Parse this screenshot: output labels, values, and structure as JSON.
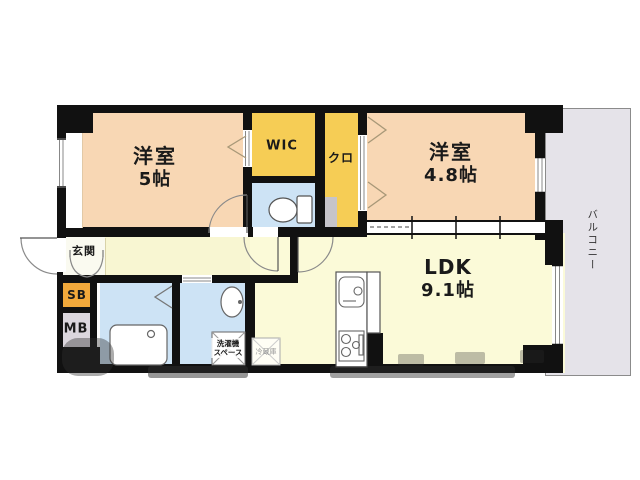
{
  "plan": {
    "rooms": {
      "bedroom1": {
        "name": "洋室",
        "size": "5帖"
      },
      "bedroom2": {
        "name": "洋室",
        "size": "4.8帖"
      },
      "ldk": {
        "name": "LDK",
        "size": "9.1帖"
      },
      "wic": {
        "name": "WIC"
      },
      "closet": {
        "name": "クロ"
      },
      "entrance": {
        "name": "玄関"
      },
      "shoe_box": {
        "name": "SB"
      },
      "meter_box": {
        "name": "MB"
      },
      "balcony": {
        "name": "バルコニー"
      }
    },
    "annotations": {
      "laundry_line1": "洗濯機",
      "laundry_line2": "スペース",
      "refrigerator": "冷蔵庫"
    },
    "icons": {
      "toilet": "toilet-icon",
      "bathtub": "bathtub-icon",
      "washbasin": "washbasin-icon",
      "kitchen_sink": "kitchen-sink-icon",
      "stove": "stove-icon"
    },
    "colors": {
      "room_peach": "#f8d7b4",
      "storage_yellow": "#f6cd55",
      "wet_area_blue": "#cde3f5",
      "living_cream": "#fbfad8",
      "hall_cream": "#f8f6d2",
      "entrance_white": "#fafaf0",
      "shoe_box_orange": "#f2a93b",
      "meter_box_gray": "#dcd7de",
      "balcony_gray": "#e5e3e9",
      "wall_black": "#111111"
    }
  }
}
